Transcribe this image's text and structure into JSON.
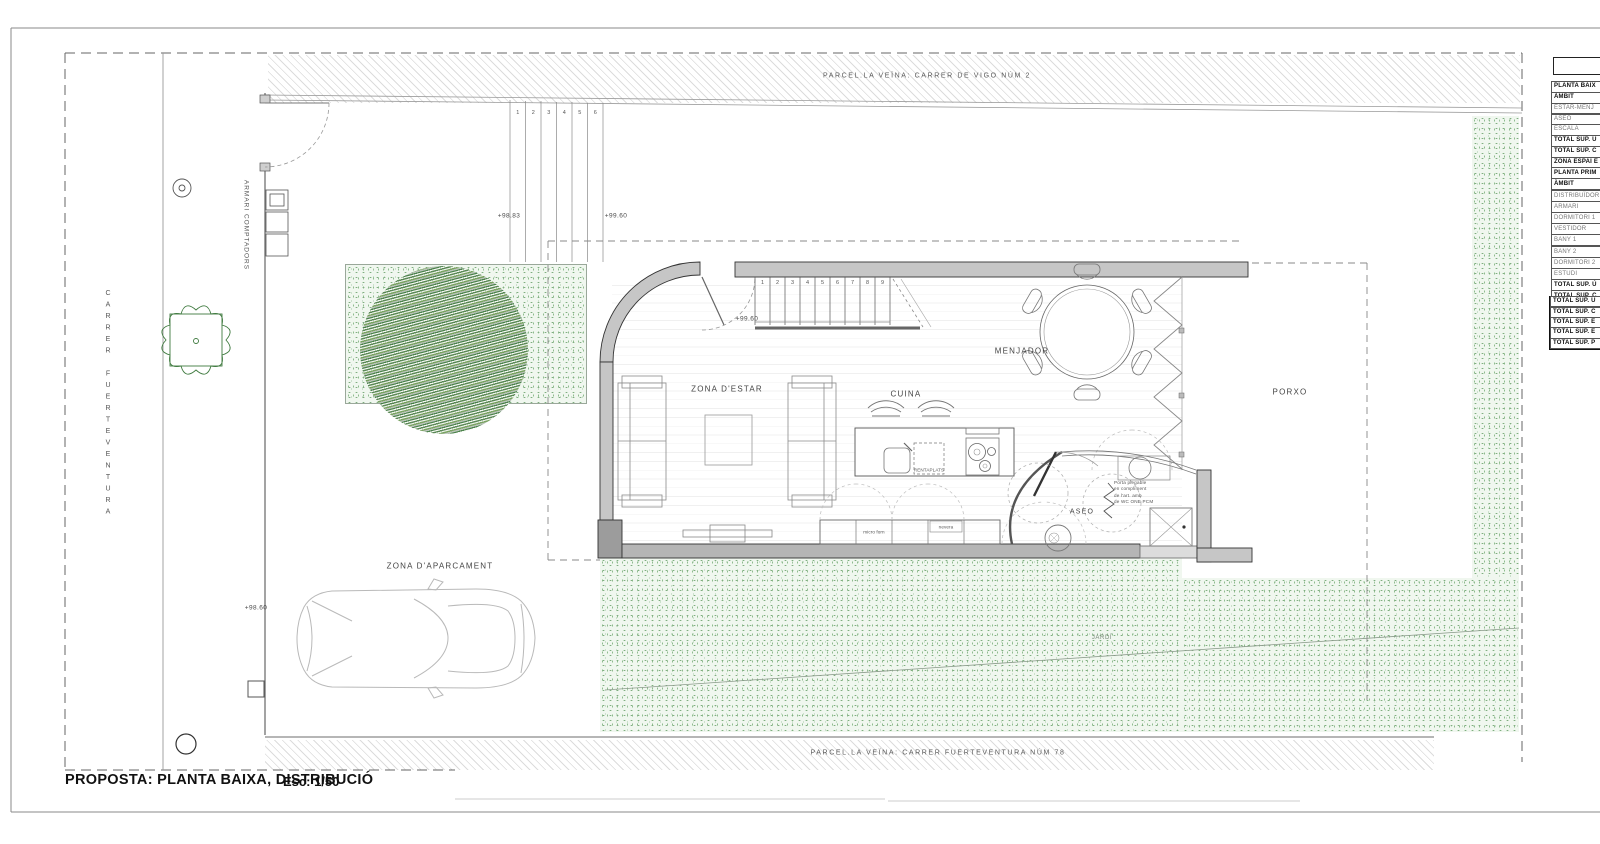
{
  "drawing": {
    "proposal_title": "PROPOSTA: PLANTA BAIXA, DISTRIBUCIÓ",
    "scale_label": "Esc: 1/50"
  },
  "site": {
    "street_name": "CARRER FUERTEVENTURA",
    "meter_cabinet_label": "ARMARI COMPTADORS",
    "neighbor_top": "PARCEL.LA VEÏNA: CARRER DE VIGO NÚM 2",
    "neighbor_bottom": "PARCEL.LA VEÏNA: CARRER FUERTEVENTURA NÚM 78",
    "garden_label": "JARDÍ",
    "parking_label": "ZONA D'APARCAMENT"
  },
  "levels": {
    "street_top": "+98.83",
    "entry_top": "+99.60",
    "interior": "+99.60",
    "parking": "+98.60"
  },
  "rooms": {
    "living": "ZONA D'ESTAR",
    "kitchen": "CUINA",
    "dining": "MENJADOR",
    "bathroom": "ASEO",
    "porch": "PORXO"
  },
  "kitchen": {
    "dishwasher": "RENTAPLATS",
    "microwave": "micro forn",
    "fridge": "nevera"
  },
  "bathroom_note": [
    "Porta plegable",
    "en compliment",
    "de l'art. amb",
    "de WC ONE PCM"
  ],
  "stairs": {
    "exterior": [
      "1",
      "2",
      "3",
      "4",
      "5",
      "6"
    ],
    "interior": [
      "1",
      "2",
      "3",
      "4",
      "5",
      "6",
      "7",
      "8",
      "9"
    ]
  },
  "area_panel": {
    "ground_floor_rows": [
      {
        "t": "PLANTA BAIX",
        "b": true
      },
      {
        "t": "ÀMBIT",
        "b": true
      },
      {
        "t": "ESTAR-MENJ",
        "b": false
      },
      {
        "t": "ASEO",
        "b": false
      },
      {
        "t": "ESCALA",
        "b": false
      },
      {
        "t": "TOTAL SUP. Ú",
        "b": true
      },
      {
        "t": "TOTAL SUP. C",
        "b": true
      },
      {
        "t": "ZONA ESPAI E",
        "b": true
      }
    ],
    "first_floor_rows": [
      {
        "t": "PLANTA PRIM",
        "b": true
      },
      {
        "t": "ÀMBIT",
        "b": true
      },
      {
        "t": "DISTRIBUÏDOR",
        "b": false
      },
      {
        "t": "ARMARI",
        "b": false
      },
      {
        "t": "DORMITORI 1",
        "b": false
      },
      {
        "t": "VESTIDOR",
        "b": false
      },
      {
        "t": "BANY 1",
        "b": false
      },
      {
        "t": "BANY 2",
        "b": false
      },
      {
        "t": "DORMITORI 2",
        "b": false
      },
      {
        "t": "ESTUDI",
        "b": false
      },
      {
        "t": "TOTAL SUP. Ú",
        "b": true
      },
      {
        "t": "TOTAL SUP. C",
        "b": true
      }
    ],
    "totals_rows": [
      {
        "t": "TOTAL SUP. Ú",
        "b": true
      },
      {
        "t": "TOTAL SUP. C",
        "b": true
      },
      {
        "t": "TOTAL SUP. E",
        "b": true
      },
      {
        "t": "TOTAL SUP. E",
        "b": true
      },
      {
        "t": "TOTAL SUP. P",
        "b": true
      }
    ]
  },
  "colors": {
    "wall_fill": "#c6c6c6",
    "wall_dark": "#9c9c9c",
    "line": "#444444",
    "green_dot": "#7fae7f",
    "green_bg": "#f0f7ef",
    "tree_green": "#3f7a3f"
  }
}
